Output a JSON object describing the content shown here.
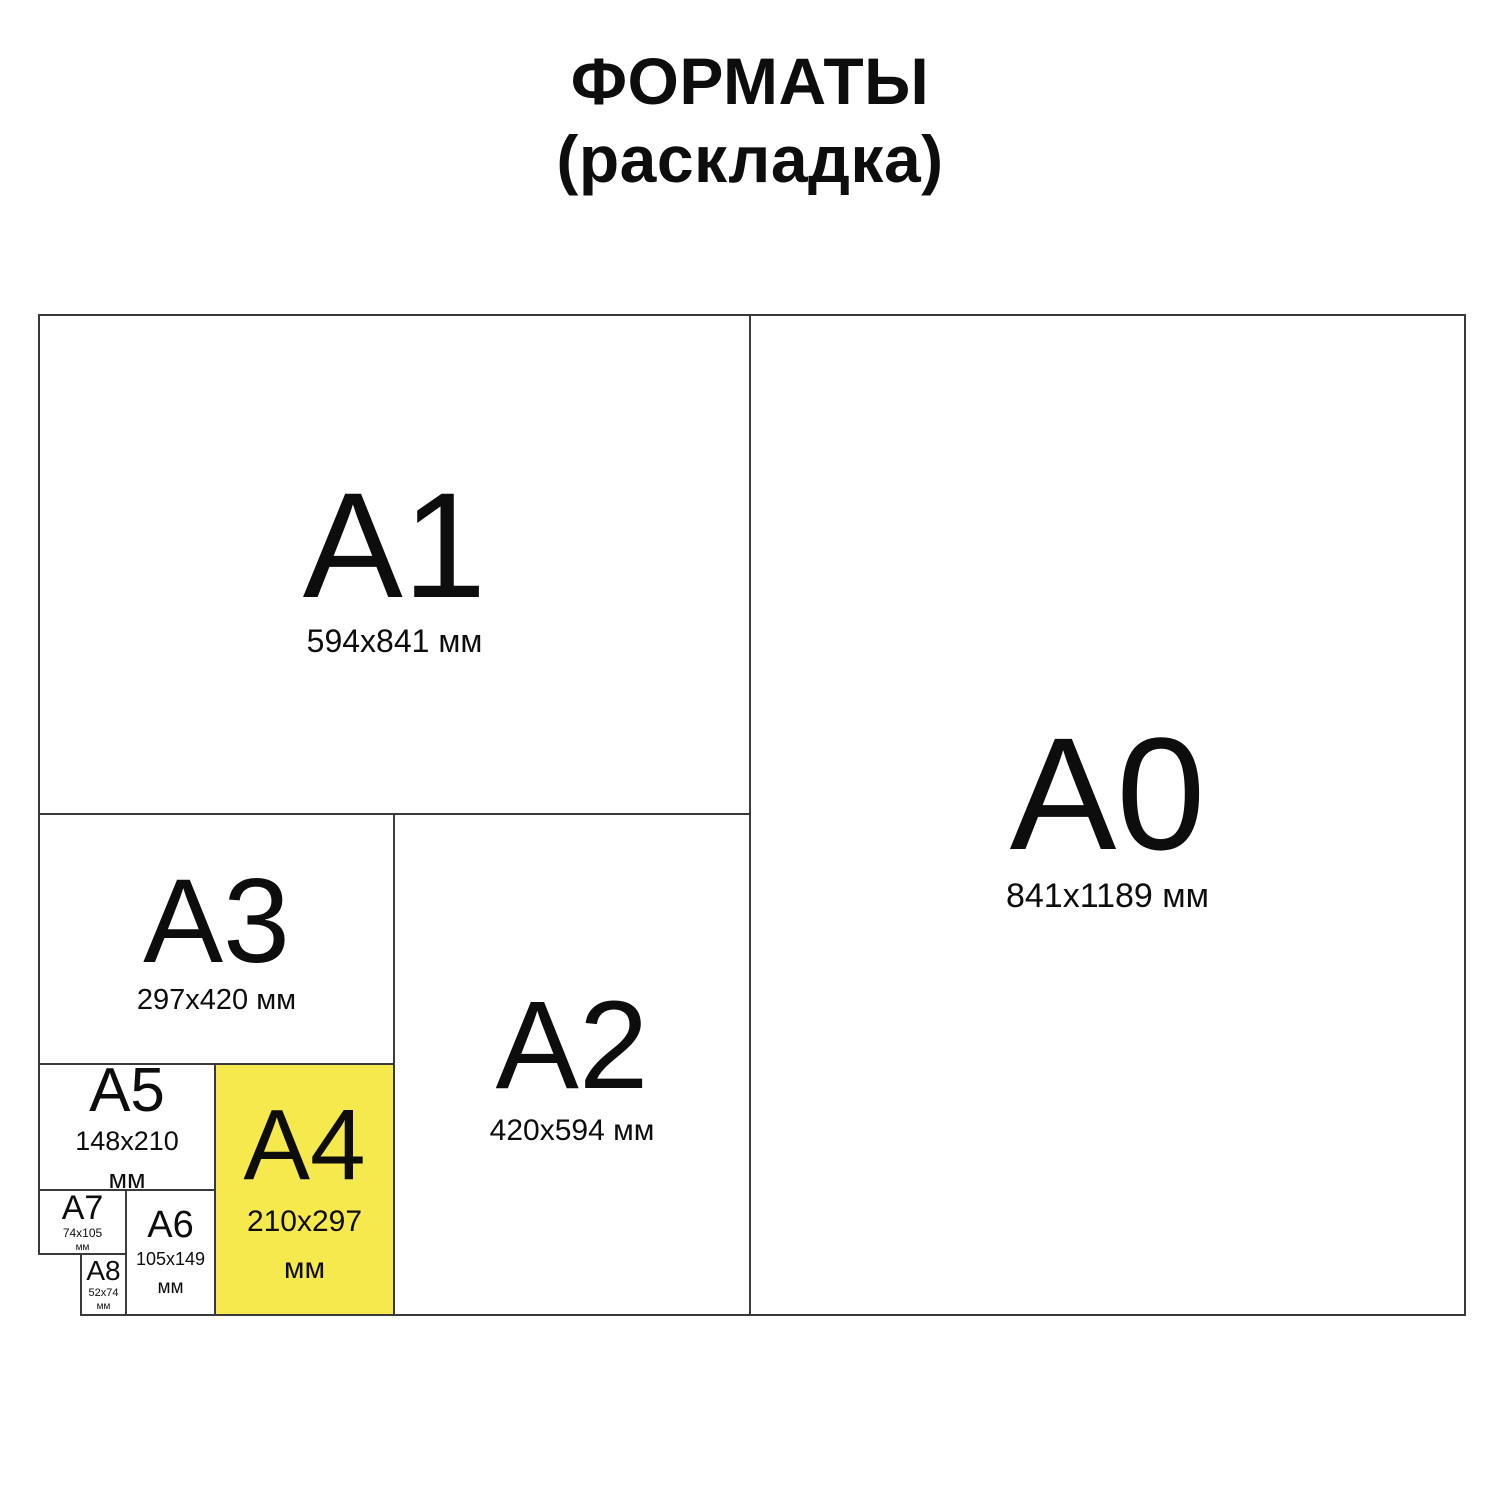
{
  "title": {
    "line1": "ФОРМАТЫ",
    "line2": "(раскладка)"
  },
  "colors": {
    "highlight_fill": "#f6e94e",
    "border": "#3a3a3a",
    "text": "#0d0d0d",
    "background": "#ffffff"
  },
  "formats": {
    "a1": {
      "label": "А1",
      "dims": "594x841 мм"
    },
    "a0": {
      "label": "А0",
      "dims": "841x1189 мм"
    },
    "a3": {
      "label": "А3",
      "dims": "297x420 мм"
    },
    "a2": {
      "label": "А2",
      "dims": "420x594 мм"
    },
    "a5": {
      "label": "А5",
      "dims": "148x210",
      "unit": "мм"
    },
    "a4": {
      "label": "А4",
      "dims": "210x297",
      "unit": "мм",
      "highlighted": true
    },
    "a7": {
      "label": "А7",
      "dims": "74x105",
      "unit": "мм"
    },
    "a6": {
      "label": "А6",
      "dims": "105x149",
      "unit": "мм"
    },
    "a8": {
      "label": "А8",
      "dims": "52x74",
      "unit": "мм"
    }
  }
}
